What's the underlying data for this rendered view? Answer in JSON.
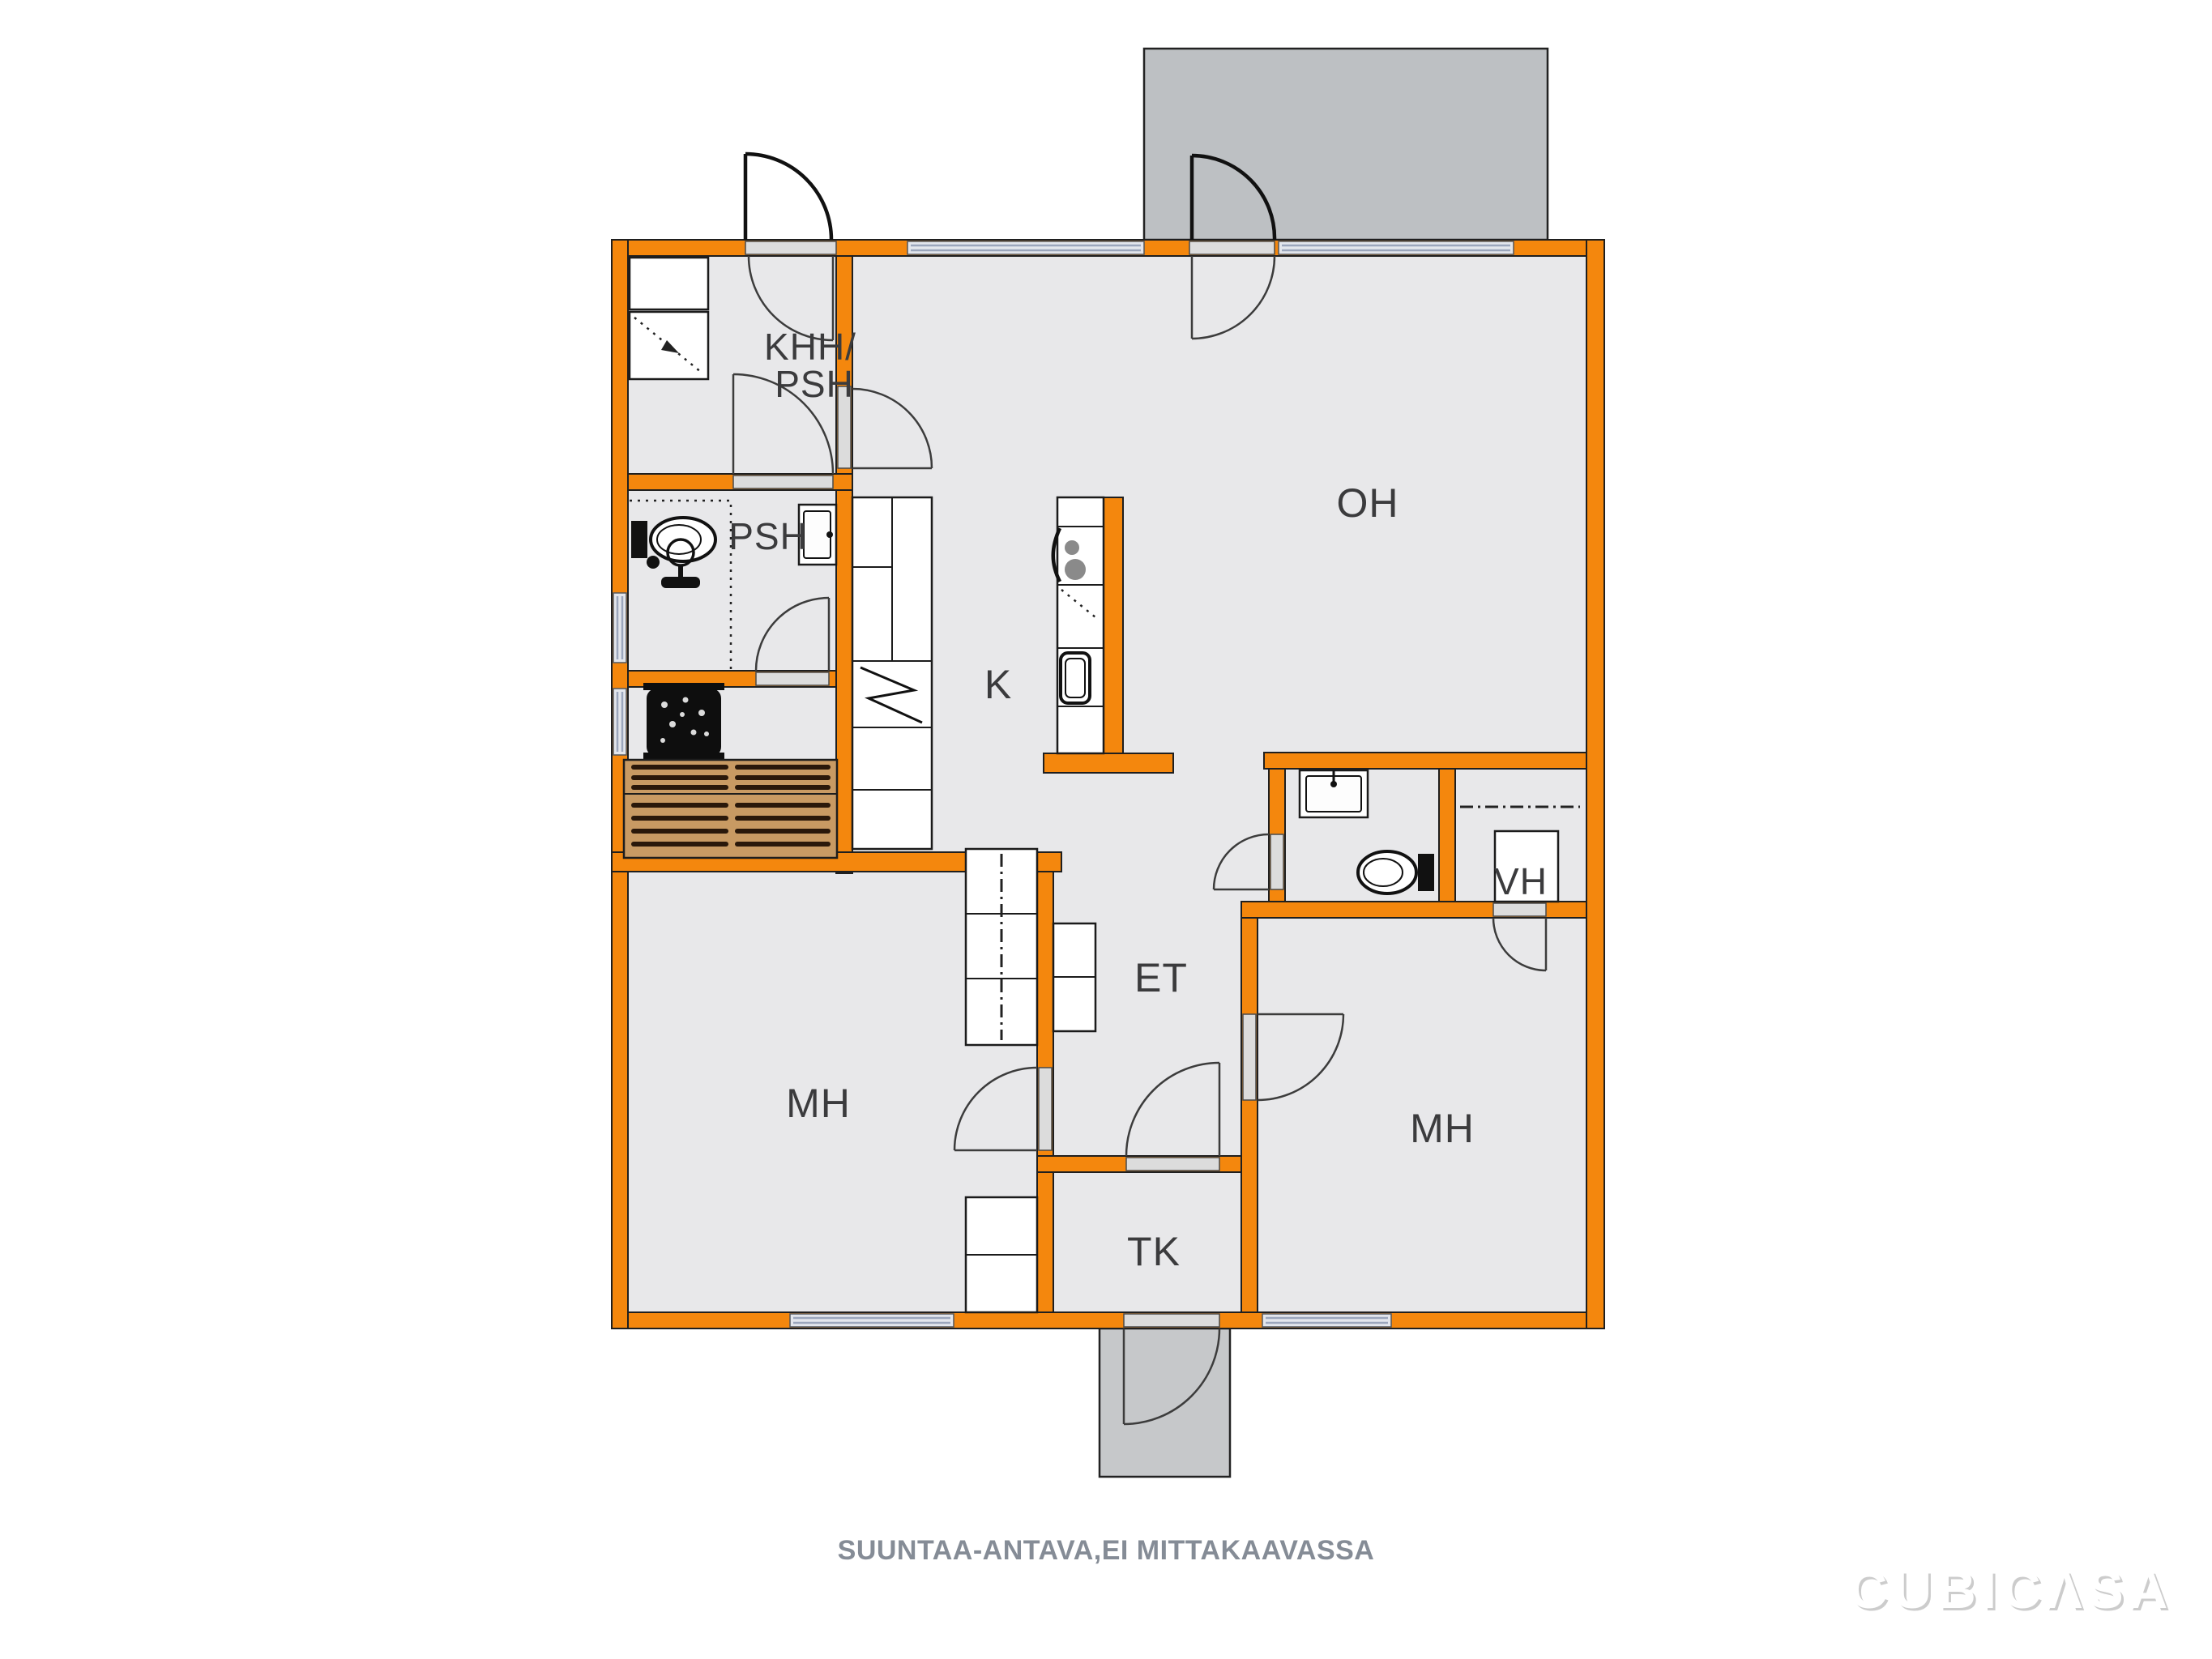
{
  "plan": {
    "wall_color": "#F4870D",
    "floor_color": "#E8E8EA",
    "balcony_color": "#BDC0C3",
    "porch_color": "#C6C8CA",
    "bench_color": "#C89A63",
    "rooms": [
      {
        "id": "khh-psh",
        "label_line1": "KHH/",
        "label_line2": "PSH"
      },
      {
        "id": "psh",
        "label": "PSH"
      },
      {
        "id": "oh",
        "label": "OH"
      },
      {
        "id": "k",
        "label": "K"
      },
      {
        "id": "et",
        "label": "ET"
      },
      {
        "id": "mh-left",
        "label": "MH"
      },
      {
        "id": "mh-right",
        "label": "MH"
      },
      {
        "id": "tk",
        "label": "TK"
      },
      {
        "id": "vh",
        "label": "VH"
      }
    ]
  },
  "footer": {
    "disclaimer": "SUUNTAA-ANTAVA,EI MITTAKAAVASSA"
  },
  "brand": {
    "logo_text": "CUBICΛSA"
  }
}
